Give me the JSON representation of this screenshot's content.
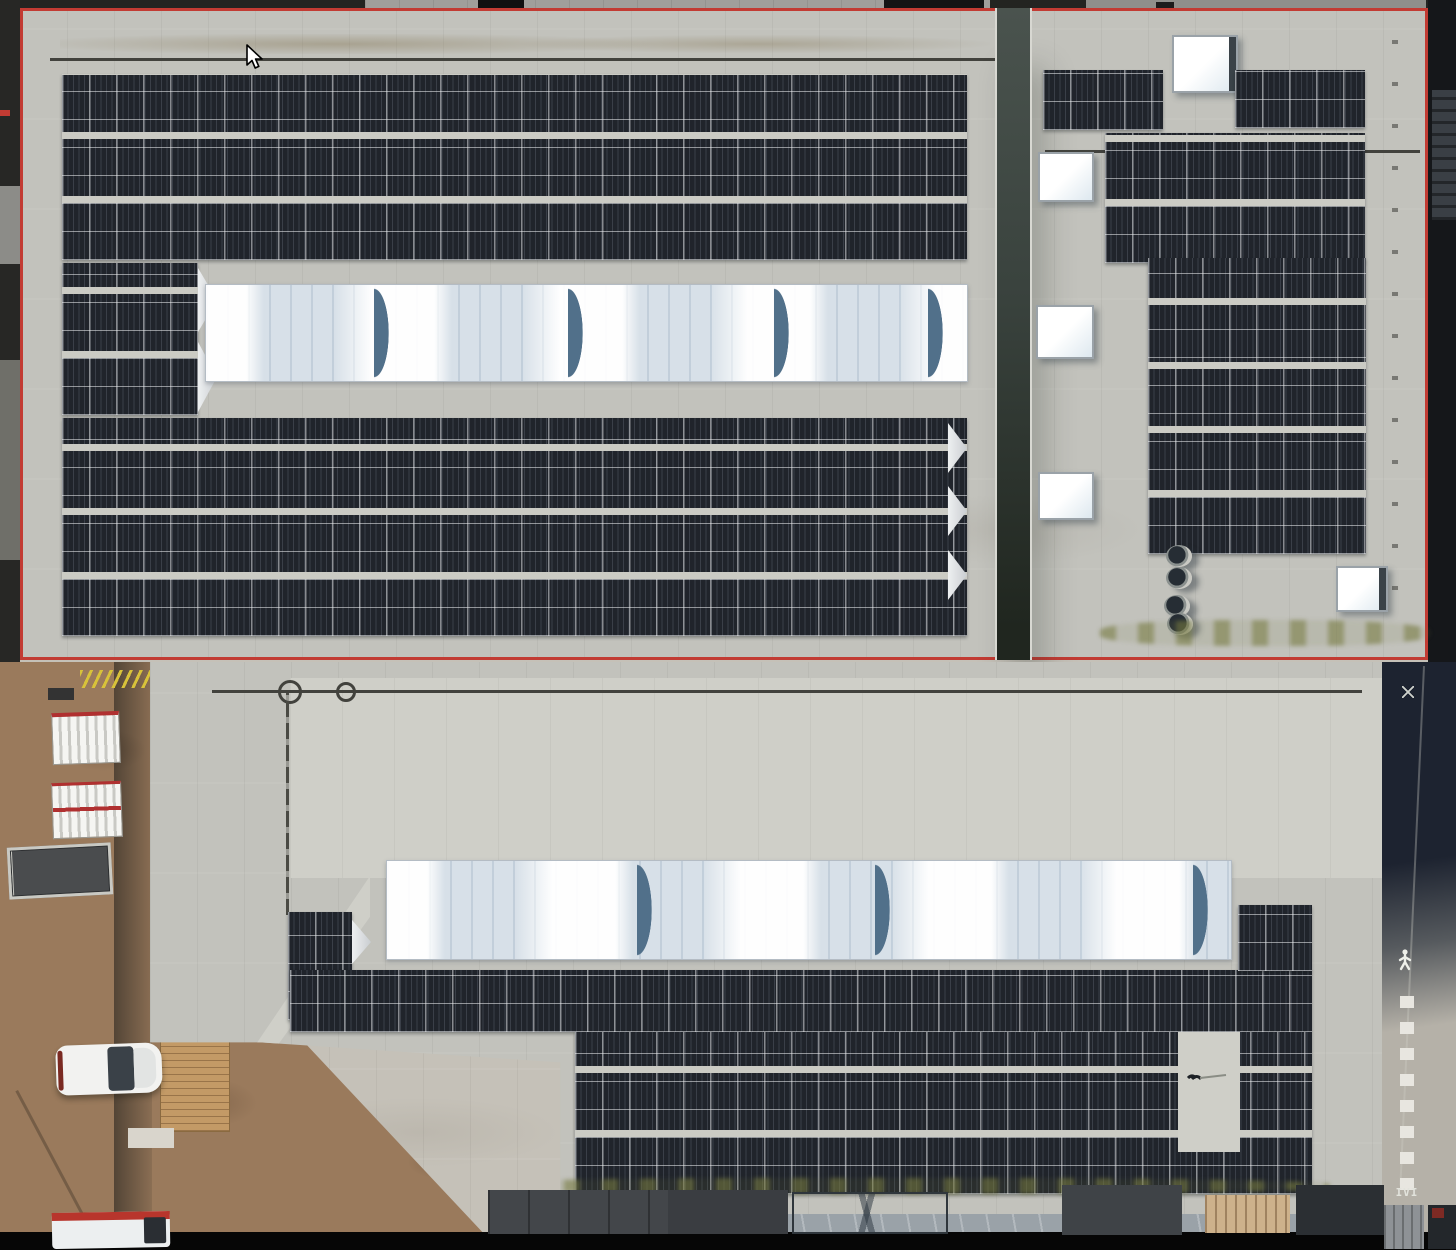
{
  "scene": {
    "type": "aerial-drone-photograph",
    "description": "Top-down aerial view of industrial warehouse rooftops covered with photovoltaic solar panel arrays, long barrel-vault skylight strips, square dome skylights, a dividing gutter valley, and a ground-level service yard with dirt, parked vehicles, trailers and pallet stacks",
    "cursor": {
      "visible": true,
      "x": 246,
      "y": 46
    }
  },
  "palette": {
    "roof_concrete": "#c2c2bc",
    "roof_concrete_bright": "#cfcfc8",
    "ground_concrete": "#c5c1b8",
    "panel_dark": "#20242b",
    "walkway": "#cbcbc4",
    "skylight_white": "#eef1f4",
    "skylight_shadow": "#51708a",
    "red_line": "#c23b33",
    "dirt": "#9a7a5c",
    "road_dark": "#1d2330",
    "valley_dark": "#39423d",
    "moss_green": "#7a7d46",
    "pallet_tan": "#c39a66",
    "black_edge": "#060606"
  },
  "roofs": {
    "top_left_hall": {
      "panel_bands_above_skylight": 3,
      "panel_bands_below_skylight": 3,
      "side_arrays_left_of_skylight": 2,
      "skylight_strip_crescents": 4
    },
    "top_right_hall": {
      "square_skylights": 5,
      "round_vents": 4,
      "panel_blocks": 4
    },
    "bottom_hall": {
      "skylight_strip_crescents": 3,
      "full_width_panel_band": 1,
      "lower_panel_bands": 3,
      "small_side_array": 1
    }
  },
  "ground": {
    "markings": {
      "pedestrian_symbol": "painted walking person",
      "walkway_dashes": "painted dashed walk lane",
      "end_label": "IVI",
      "yellow_chain": "yellow safety chain at roof access"
    },
    "vehicles_and_objects": [
      "white-car",
      "white-red-van",
      "market-trailer-1",
      "market-trailer-2",
      "flatbed-ramp-trailer",
      "pallet-stack",
      "dark-crates",
      "canopy-box",
      "containers"
    ]
  }
}
